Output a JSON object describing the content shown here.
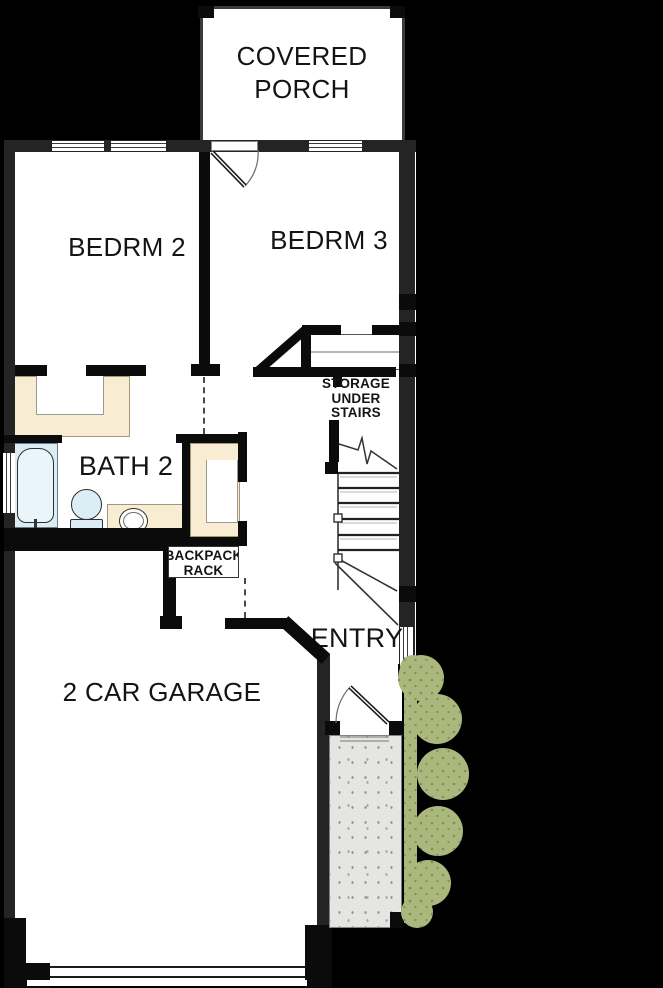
{
  "labels": {
    "covered_porch": {
      "line1": "COVERED",
      "line2": "PORCH"
    },
    "bedroom2": "BEDRM 2",
    "bedroom3": "BEDRM 3",
    "bath2": "BATH 2",
    "storage_under_stairs": {
      "line1": "STORAGE",
      "line2": "UNDER",
      "line3": "STAIRS"
    },
    "backpack_rack": {
      "line1": "BACKPACK",
      "line2": "RACK"
    },
    "entry": "ENTRY",
    "garage": "2 CAR GARAGE"
  },
  "colors": {
    "background": "#000000",
    "floor": "#ffffff",
    "exterior_wall": "#242424",
    "interior_wall": "#0b0b0b",
    "cabinet_cream": "#f8ecd2",
    "fixture_blue": "#dcedf6",
    "stoop_gray": "#e5e5e1",
    "shrub_green": "#abb87d",
    "shrub_dot": "#7f9156"
  }
}
